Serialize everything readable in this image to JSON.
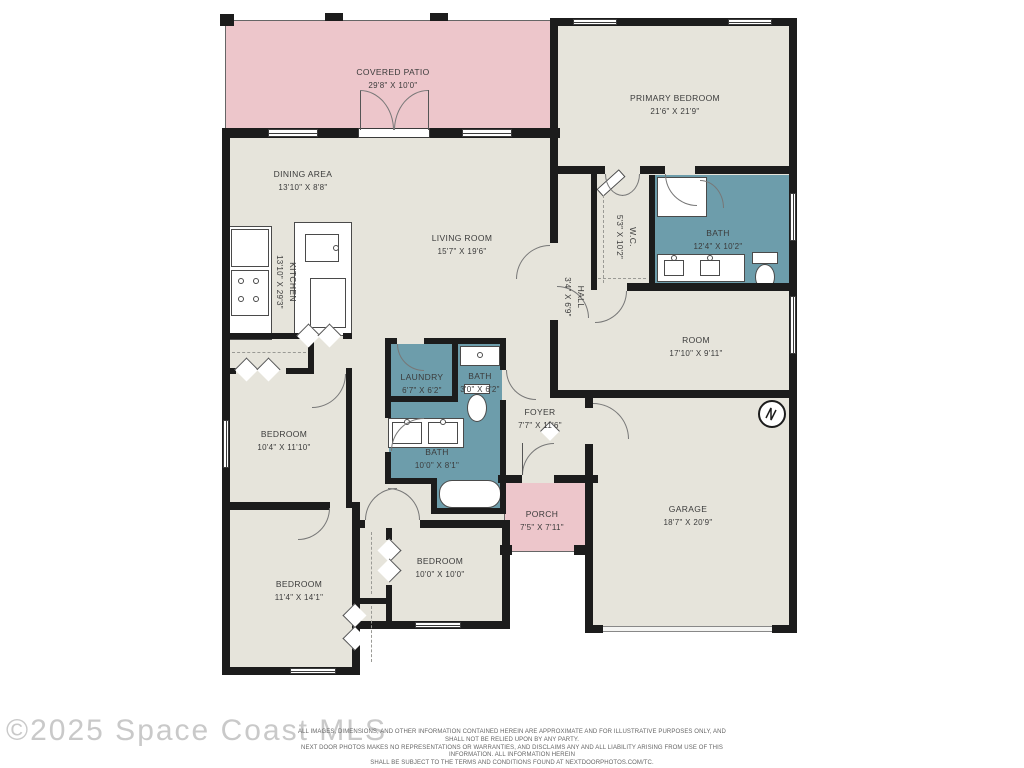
{
  "colors": {
    "floor": "#e6e4db",
    "patio_porch": "#edc6cb",
    "wet_rooms": "#6d9dab",
    "walls": "#1c1c1c"
  },
  "rooms": {
    "covered_patio": {
      "name": "COVERED PATIO",
      "dims": "29'8\" X 10'0\""
    },
    "primary_bedroom": {
      "name": "PRIMARY BEDROOM",
      "dims": "21'6\" X 21'9\""
    },
    "dining_area": {
      "name": "DINING AREA",
      "dims": "13'10\" X 8'8\""
    },
    "living_room": {
      "name": "LIVING ROOM",
      "dims": "15'7\" X 19'6\""
    },
    "kitchen": {
      "name": "KITCHEN",
      "dims": "13'10\" X 29'3\""
    },
    "wc": {
      "name": "W.C.",
      "dims": "5'3\" X 10'2\""
    },
    "primary_bath": {
      "name": "BATH",
      "dims": "12'4\" X 10'2\""
    },
    "hall": {
      "name": "HALL",
      "dims": "3'4\" X 6'9\""
    },
    "room": {
      "name": "ROOM",
      "dims": "17'10\" X 9'11\""
    },
    "laundry": {
      "name": "LAUNDRY",
      "dims": "6'7\" X 6'2\""
    },
    "bath_small": {
      "name": "BATH",
      "dims": "3'0\" X 6'2\""
    },
    "bath_main": {
      "name": "BATH",
      "dims": "10'0\" X 8'1\""
    },
    "foyer": {
      "name": "FOYER",
      "dims": "7'7\" X 11'6\""
    },
    "porch": {
      "name": "PORCH",
      "dims": "7'5\" X 7'11\""
    },
    "garage": {
      "name": "GARAGE",
      "dims": "18'7\" X 20'9\""
    },
    "bedroom_left": {
      "name": "BEDROOM",
      "dims": "10'4\" X 11'10\""
    },
    "bedroom_bottom_left": {
      "name": "BEDROOM",
      "dims": "11'4\" X 14'1\""
    },
    "bedroom_bottom_middle": {
      "name": "BEDROOM",
      "dims": "10'0\" X 10'0\""
    }
  },
  "footer": {
    "watermark": "©2025 Space Coast MLS",
    "disclaimer_line1": "ALL IMAGES, DIMENSIONS, AND OTHER INFORMATION CONTAINED HEREIN ARE APPROXIMATE AND FOR ILLUSTRATIVE PURPOSES ONLY, AND SHALL NOT BE RELIED UPON BY ANY PARTY.",
    "disclaimer_line2": "NEXT DOOR PHOTOS MAKES NO REPRESENTATIONS OR WARRANTIES, AND DISCLAIMS ANY AND ALL LIABILITY ARISING FROM USE OF THIS INFORMATION. ALL INFORMATION HEREIN",
    "disclaimer_line3": "SHALL BE SUBJECT TO THE TERMS AND CONDITIONS FOUND AT NEXTDOORPHOTOS.COM/TC."
  }
}
